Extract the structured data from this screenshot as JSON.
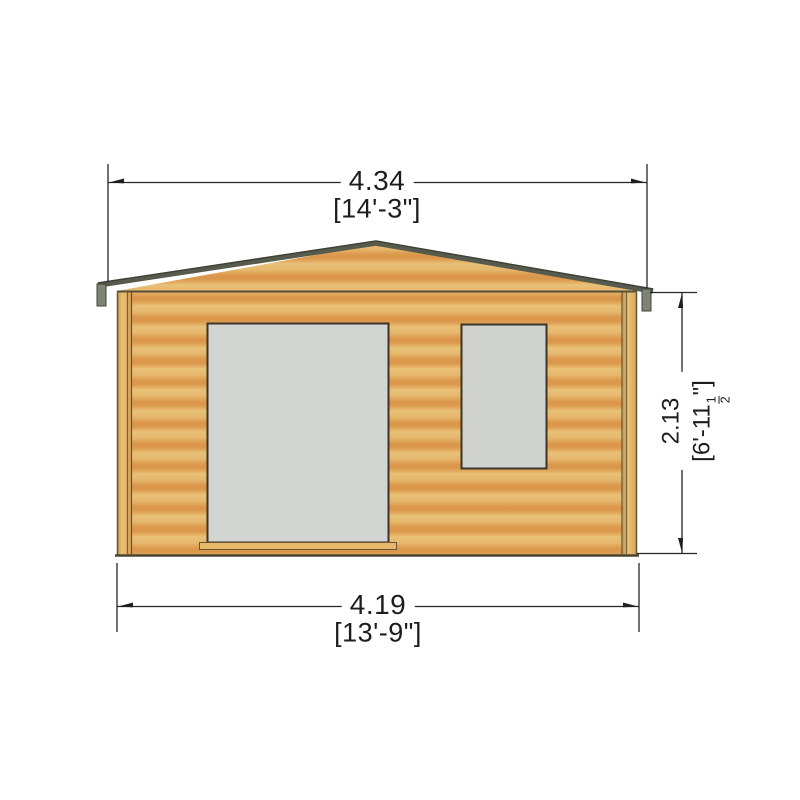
{
  "drawing": {
    "subject": "log-cabin-front-elevation",
    "dim_overall_width": {
      "metric": "4.34",
      "imperial": "[14'-3\"]"
    },
    "dim_wall_width": {
      "metric": "4.19",
      "imperial": "[13'-9\"]"
    },
    "dim_height": {
      "metric": "2.13",
      "imperial_prefix": "[6'-11",
      "fraction_num": "1",
      "fraction_den": "2",
      "imperial_suffix": "\"]"
    }
  },
  "colors": {
    "background": "#ffffff",
    "wood_light": "#e9c178",
    "wood_dark": "#db974b",
    "roof_edge": "#565b4d",
    "fascia_cap": "#7d8474",
    "opening_fill": "#d3d5d2",
    "opening_outline": "#3b3528",
    "dimension_line": "#262626",
    "text": "#1d1d1d"
  }
}
